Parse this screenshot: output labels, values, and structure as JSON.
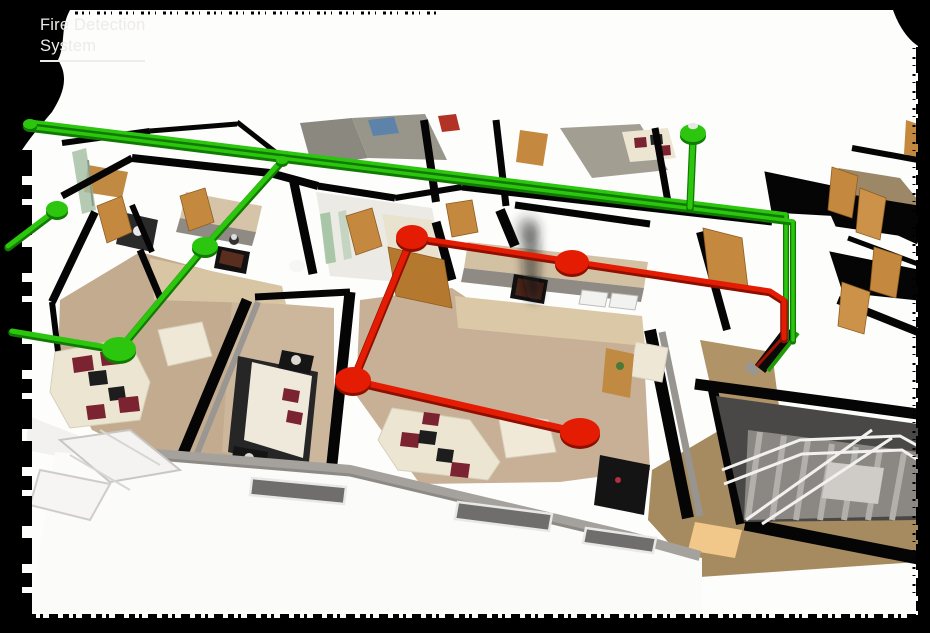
{
  "page": {
    "title_line1": "Fire Detection",
    "title_line2": "System",
    "title_color": "#edebe7",
    "background_color": "#000000",
    "paper_color": "#fdfdfc"
  },
  "network": {
    "green_loop": {
      "color": "#2bc60d",
      "shadow": "#117a02",
      "edges": [
        {
          "name": "trunk-upper",
          "w": 3.5,
          "pts": [
            [
              28,
              121
            ],
            [
              786,
              214
            ],
            [
              786,
              338
            ]
          ]
        },
        {
          "name": "trunk-lower",
          "w": 3.5,
          "pts": [
            [
              28,
              127
            ],
            [
              793,
              221
            ],
            [
              793,
              340
            ]
          ]
        },
        {
          "name": "branch-left-kitchen",
          "w": 5,
          "pts": [
            [
              282,
              160
            ],
            [
              205,
              246
            ],
            [
              119,
              349
            ]
          ]
        },
        {
          "name": "spur-upper-left",
          "w": 5,
          "pts": [
            [
              57,
              209
            ],
            [
              8,
              246
            ]
          ]
        },
        {
          "name": "spur-lower-left",
          "w": 5,
          "pts": [
            [
              119,
              349
            ],
            [
              12,
              331
            ]
          ]
        },
        {
          "name": "drop-upper-room",
          "w": 5,
          "pts": [
            [
              693,
              138
            ],
            [
              690,
              207
            ]
          ]
        }
      ],
      "nodes": [
        {
          "name": "cable-endcap",
          "x": 30,
          "y": 124,
          "rx": 7,
          "ry": 5
        },
        {
          "name": "junction",
          "x": 282,
          "y": 160,
          "rx": 6,
          "ry": 4
        },
        {
          "name": "detector",
          "x": 57,
          "y": 209,
          "rx": 11,
          "ry": 8
        },
        {
          "name": "detector",
          "x": 205,
          "y": 246,
          "rx": 13,
          "ry": 9
        },
        {
          "name": "detector",
          "x": 119,
          "y": 349,
          "rx": 17,
          "ry": 12
        },
        {
          "name": "detector",
          "x": 693,
          "y": 133,
          "rx": 13,
          "ry": 9,
          "cap": true
        }
      ]
    },
    "red_loop": {
      "color": "#e41c03",
      "shadow": "#8e0f00",
      "edges": [
        {
          "name": "main-run",
          "w": 5,
          "pts": [
            [
              412,
              237
            ],
            [
              770,
              291
            ],
            [
              784,
              300
            ],
            [
              784,
              338
            ]
          ]
        },
        {
          "name": "left-drop",
          "w": 6,
          "pts": [
            [
              412,
              237
            ],
            [
              353,
              380
            ]
          ]
        },
        {
          "name": "bottom-run",
          "w": 6,
          "pts": [
            [
              353,
              380
            ],
            [
              580,
              432
            ]
          ]
        }
      ],
      "nodes": [
        {
          "name": "detector",
          "x": 412,
          "y": 237,
          "rx": 16,
          "ry": 12
        },
        {
          "name": "detector",
          "x": 572,
          "y": 262,
          "rx": 17,
          "ry": 12
        },
        {
          "name": "detector",
          "x": 353,
          "y": 380,
          "rx": 18,
          "ry": 13
        },
        {
          "name": "detector",
          "x": 580,
          "y": 432,
          "rx": 20,
          "ry": 14
        }
      ]
    }
  }
}
